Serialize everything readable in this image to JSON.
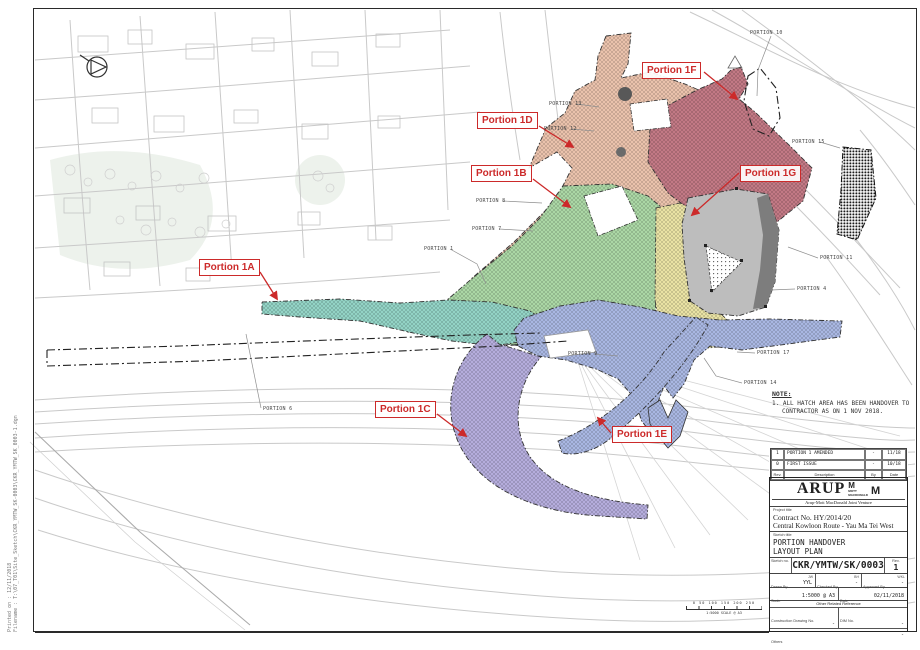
{
  "colors": {
    "callout_red": "#cc2a2a",
    "portion_1a": "#93d3c5",
    "portion_1b": "#abd7a5",
    "portion_1c": "#b5addc",
    "portion_1d": "#eac2ac",
    "portion_1e": "#a9b7e2",
    "portion_1fg": "#c27985",
    "yellow_zone": "#e9e2a4",
    "gray_zone": "#bdbdbd",
    "gray_zone_dark": "#7d7d7d"
  },
  "map": {
    "callouts": [
      {
        "id": "portion-1a",
        "label": "Portion 1A",
        "x": 199,
        "y": 259
      },
      {
        "id": "portion-1b",
        "label": "Portion 1B",
        "x": 471,
        "y": 165
      },
      {
        "id": "portion-1c",
        "label": "Portion 1C",
        "x": 375,
        "y": 401
      },
      {
        "id": "portion-1d",
        "label": "Portion 1D",
        "x": 477,
        "y": 112
      },
      {
        "id": "portion-1e",
        "label": "Portion 1E",
        "x": 612,
        "y": 426
      },
      {
        "id": "portion-1f",
        "label": "Portion 1F",
        "x": 642,
        "y": 62
      },
      {
        "id": "portion-1g",
        "label": "Portion 1G",
        "x": 740,
        "y": 165
      }
    ],
    "portion_labels": [
      {
        "label": "PORTION 10",
        "x": 750,
        "y": 30
      },
      {
        "label": "PORTION 13",
        "x": 549,
        "y": 101
      },
      {
        "label": "PORTION 12",
        "x": 544,
        "y": 126
      },
      {
        "label": "PORTION 15",
        "x": 792,
        "y": 139
      },
      {
        "label": "PORTION 8",
        "x": 476,
        "y": 198
      },
      {
        "label": "PORTION 7",
        "x": 472,
        "y": 226
      },
      {
        "label": "PORTION 1",
        "x": 424,
        "y": 246
      },
      {
        "label": "PORTION 11",
        "x": 820,
        "y": 255
      },
      {
        "label": "PORTION 4",
        "x": 797,
        "y": 286
      },
      {
        "label": "PORTION 9",
        "x": 568,
        "y": 351
      },
      {
        "label": "PORTION 17",
        "x": 757,
        "y": 350
      },
      {
        "label": "PORTION 14",
        "x": 744,
        "y": 380
      },
      {
        "label": "PORTION 6",
        "x": 263,
        "y": 406
      }
    ]
  },
  "note": {
    "title": "NOTE:",
    "line1": "1.  ALL HATCH AREA HAS BEEN HANDOVER TO",
    "line2": "CONTRACTOR AS ON 1 NOV 2018."
  },
  "scale_bar": {
    "numbers": "0 50 100 150 200 250",
    "caption": "1:5000 SCALE @ A3"
  },
  "left_margin": {
    "line1": "Printed on : 12/11/2018",
    "line2": "Filename : T:\\07_T01\\Site_Sketch\\CKR_YMTW_SK-0003\\CKR_YMTW_SK_0003-1.dgn"
  },
  "title_block": {
    "revisions": [
      {
        "rev": "1",
        "description": "PORTION 1 AMENDED",
        "by": "-",
        "date": "11/18"
      },
      {
        "rev": "0",
        "description": "FIRST ISSUE",
        "by": "-",
        "date": "10/18"
      }
    ],
    "rev_headers": {
      "rev": "Rev.",
      "description": "Description",
      "by": "By",
      "date": "Date"
    },
    "logo": {
      "arup": "ARUP",
      "m1": "M",
      "mott": "MOTT",
      "macdonald": "MACDONALD",
      "m2": "M",
      "jv": "Arup-Mott MacDonald Joint Venture"
    },
    "project": {
      "label": "Project title",
      "line1": "Contract No. HY/2014/20",
      "line2": "Central Kowloon Route - Yau Ma Tei West"
    },
    "sketch": {
      "label": "Sketch title",
      "line1": "PORTION HANDOVER",
      "line2": "LAYOUT PLAN"
    },
    "sketch_no": {
      "label": "Sketch no.",
      "value": "CKR/YMTW/SK/0003",
      "rev_label": "Rev.",
      "rev_value": "1"
    },
    "people": {
      "drawn_label": "Drawn By",
      "drawn_sub": "JW",
      "drawn_value": "YYL",
      "checked_label": "Checked By",
      "checked_sub": "BH",
      "checked_value": "-",
      "approved_label": "Approved By",
      "approved_sub": "WKL",
      "approved_value": "-"
    },
    "scale": {
      "label": "Scale",
      "value": "1:5000 @ A3"
    },
    "date": {
      "label": "Date",
      "value": "02/11/2018"
    },
    "other_ref": {
      "header": "Other Related Reference",
      "construction_label": "Construction Drawing No.",
      "construction_value": "-",
      "dim_label": "DIM No.",
      "dim_value": "-",
      "others_label": "Others",
      "others_value": "-"
    }
  }
}
